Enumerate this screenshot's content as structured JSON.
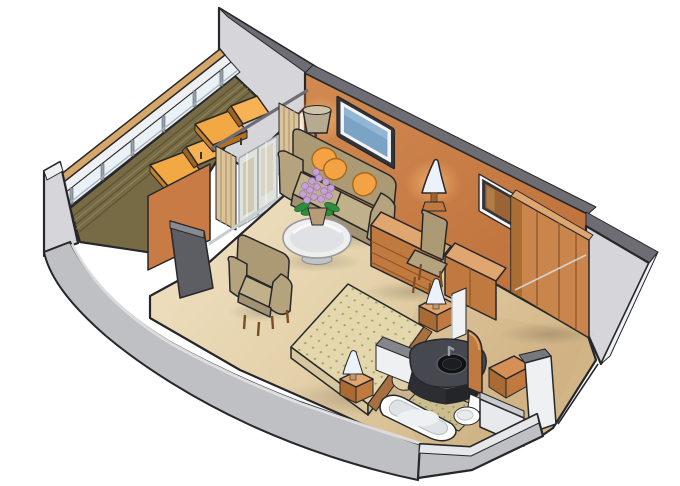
{
  "figure": {
    "kind": "Isometric cutaway illustration",
    "subject": "Stateroom floor plan with private balcony",
    "rooms": [
      {
        "name": "balcony",
        "items": [
          "glass railing with wood top rail",
          "plank deck",
          "two sun loungers with orange cushions",
          "tall partition wall"
        ]
      },
      {
        "name": "living-area",
        "items": [
          "sliding glass balcony door with curtains",
          "sofa with orange throw pillows",
          "floor lamp",
          "round glass coffee table",
          "flower pot with purple flowers",
          "armchair",
          "open gray door"
        ]
      },
      {
        "name": "media-wall",
        "items": [
          "flat screen on wall",
          "dresser with drawers",
          "tv cabinet",
          "desk chair",
          "table lamp",
          "framed mirror",
          "wardrobe with luggage rail"
        ]
      },
      {
        "name": "bedroom",
        "items": [
          "double bed with dotted bedspread",
          "two pillows",
          "two nightstands with bedside lamps"
        ]
      },
      {
        "name": "bathroom",
        "items": [
          "dark vanity with round sink",
          "bathtub",
          "toilet",
          "dotted tile floor",
          "white partition walls"
        ]
      },
      {
        "name": "entry",
        "items": [
          "orange cabinet",
          "white corridor walls",
          "door opening"
        ]
      }
    ]
  },
  "palette": {
    "outline": "#26272b",
    "wall_orange": "#c87b44",
    "wall_orange_dark": "#a5682f",
    "wall_glow": "#f0b273",
    "wood_face": "#c9854c",
    "wood_top": "#e0a670",
    "wood_dark": "#a96a33",
    "wood_mid": "#c07a40",
    "drawer_line": "#8f5526",
    "khaki": "#b4a37d",
    "khaki_light": "#c0b18b",
    "khaki_dark": "#ab9a74",
    "khaki_deep": "#a39272",
    "cushion_orange": "#f3a344",
    "lounger_orange": "#f2a843",
    "carpet_light": "#f0e3c6",
    "carpet_dark": "#d2b586",
    "gray_light": "#d6d6da",
    "gray_mid": "#bfc0c4",
    "gray_dark": "#6d6d73",
    "white_cap": "#eef0f2",
    "deck": "#776b45",
    "deck_line": "#554c30",
    "rail_wood": "#d6a768",
    "glass": "#e9f1f7",
    "door_glass": "#dde3dd",
    "screen_blue": "#7ba3c6",
    "frame_dark": "#33343a",
    "frame_white": "#f4f4f4",
    "mirror_brown": "#9b6434",
    "bed_base": "#e4d6ad",
    "bed_dot": "#99a255",
    "bed_side": "#d6c79e",
    "pillow": "#ddd0a9",
    "lamp_shade": "#ecf2f9",
    "lamp_gray": "#b6aa91",
    "vanity": "#45484e",
    "vanity_dark": "#2c2e33",
    "sink": "#101113",
    "tile": "#ccbd8e",
    "tile_dot": "#8d8b57",
    "fixture_white": "#fbfcfd",
    "flower_purple": "#c6a1d7",
    "leaf_green": "#2f8c3f",
    "pot_tan": "#b59b78",
    "curtain": "#d8c39a",
    "curtain_stripe": "#b39569",
    "door_gray": "#5c5e63"
  }
}
